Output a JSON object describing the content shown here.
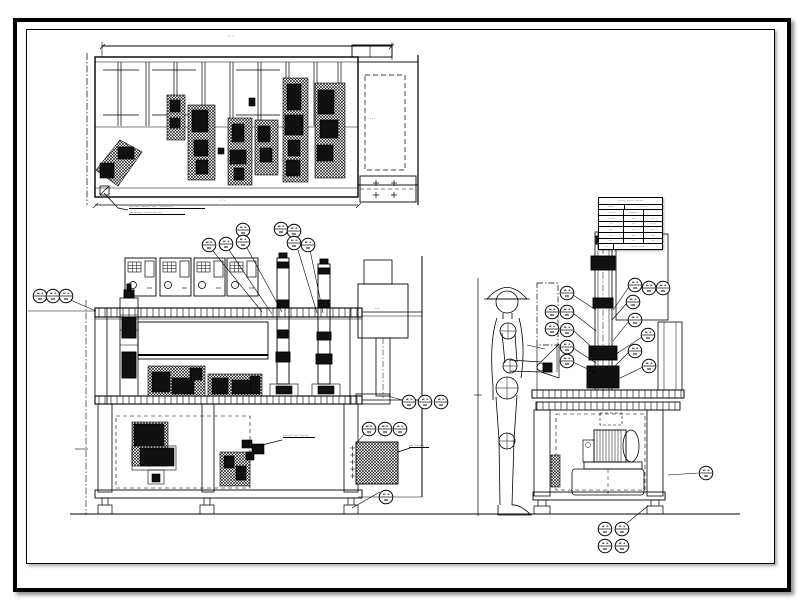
{
  "frame": {
    "background": "#ffffff",
    "line_color": "#000000"
  },
  "plan_view": {
    "dim_top_label": "-··-",
    "dim_bottom_label": "-·-",
    "leader_note_line1": "—·— ——·— ·———",
    "leader_note_line2": "——— ————"
  },
  "front_view": {
    "component_note": "——·—·——",
    "panel_note": "—·——",
    "step_box_dots": "···"
  },
  "side_view": {
    "extension_dots": "···"
  },
  "parts_table": {
    "title": "—·—· ——·· —·—",
    "header": [
      "——·",
      "·———"
    ],
    "rows": [
      [
        "·——",
        "———",
        ""
      ],
      [
        "——·",
        "—",
        "—·"
      ],
      [
        "·—",
        "—",
        "——"
      ],
      [
        "—·",
        "—",
        "—·"
      ],
      [
        "··—·",
        "—",
        "—"
      ],
      [
        "·—··",
        "—",
        "—"
      ]
    ],
    "footer": [
      "—",
      "·——·——"
    ]
  }
}
